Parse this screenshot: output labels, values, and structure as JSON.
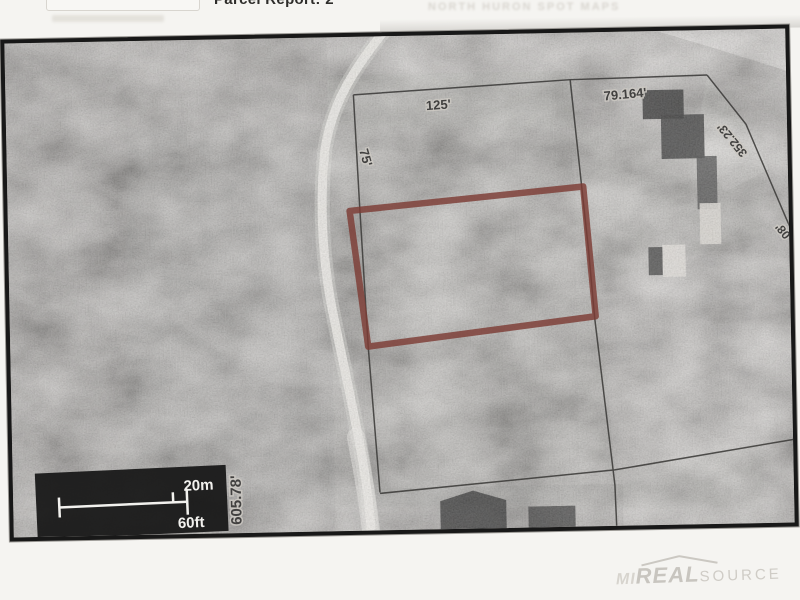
{
  "header": {
    "title_clipped": "Parcel Report: 2",
    "faint_text": "NORTH HURON SPOT MAPS"
  },
  "map": {
    "dimensions": {
      "top": "125'",
      "northeast": "79.164'",
      "diagonal": "352.23'",
      "west": "75'",
      "road_frontage": "605.78'",
      "edge_partial": "08'"
    },
    "scale_bar": {
      "metric": "20m",
      "imperial": "60ft"
    },
    "watermark": {
      "part1": "MI",
      "part2": "REAL",
      "part3": "SOURCE"
    },
    "colors": {
      "parcel_outline": "#7c3c34",
      "survey_line": "#3f3e3c",
      "scale_box_bg": "#151515",
      "road": "#eceae6"
    }
  }
}
